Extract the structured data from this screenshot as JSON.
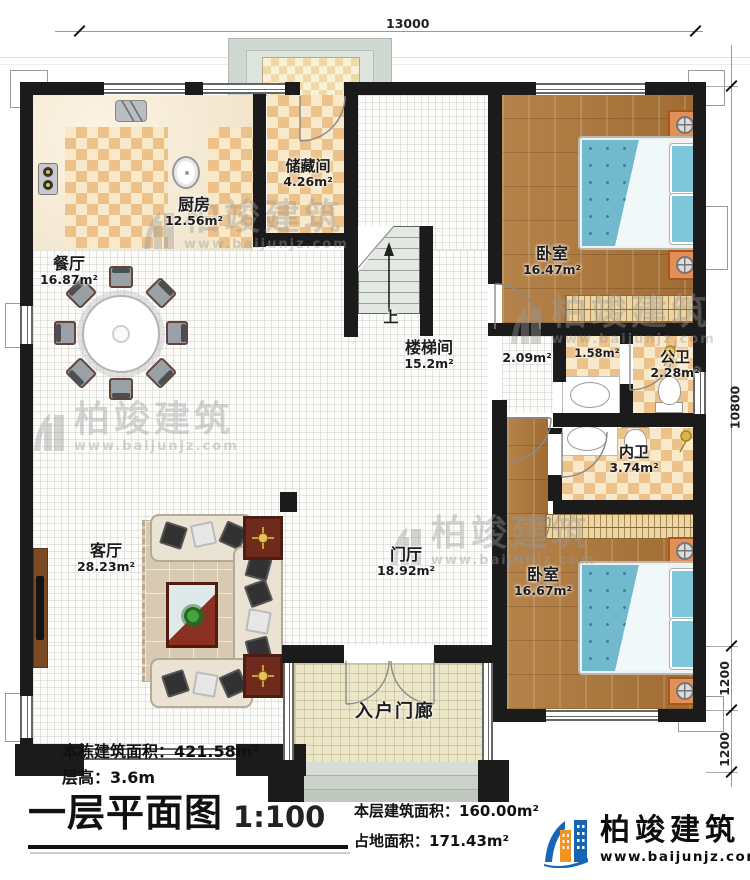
{
  "dimensions": {
    "top_width": "13000",
    "right_height": "10800",
    "right_seg_a": "1200",
    "right_seg_b": "1200"
  },
  "rooms": {
    "kitchen": {
      "name": "厨房",
      "area": "12.56m²"
    },
    "storage": {
      "name": "储藏间",
      "area": "4.26m²"
    },
    "dining": {
      "name": "餐厅",
      "area": "16.87m²"
    },
    "bedroom1": {
      "name": "卧室",
      "area": "16.47m²"
    },
    "stairwell": {
      "name": "楼梯间",
      "area": "15.2m²"
    },
    "stair_hall": {
      "area": "2.09m²"
    },
    "closet": {
      "area": "1.58m²"
    },
    "public_bath": {
      "name": "公卫",
      "area": "2.28m²"
    },
    "ensuite_bath": {
      "name": "内卫",
      "area": "3.74m²"
    },
    "living": {
      "name": "客厅",
      "area": "28.23m²"
    },
    "foyer": {
      "name": "门厅",
      "area": "18.92m²"
    },
    "bedroom2": {
      "name": "卧室",
      "area": "16.67m²"
    },
    "entry_porch": {
      "name": "入户门廊"
    }
  },
  "stairs": {
    "up": "上"
  },
  "titleblock": {
    "building_total_label": "本栋建筑面积：",
    "building_total_value": "421.58m²",
    "floor_height_label": "层高：",
    "floor_height_value": "3.6m",
    "plan_title": "一层平面图",
    "plan_scale": "1:100",
    "floor_area_label": "本层建筑面积：",
    "floor_area_value": "160.00m²",
    "footprint_label": "占地面积：",
    "footprint_value": "171.43m²"
  },
  "brand": {
    "name": "柏竣建筑",
    "website": "www.baijunjz.com"
  },
  "colors": {
    "brand_blue": "#1766b5",
    "brand_orange": "#f29421",
    "wall": "#1b1b1b"
  }
}
